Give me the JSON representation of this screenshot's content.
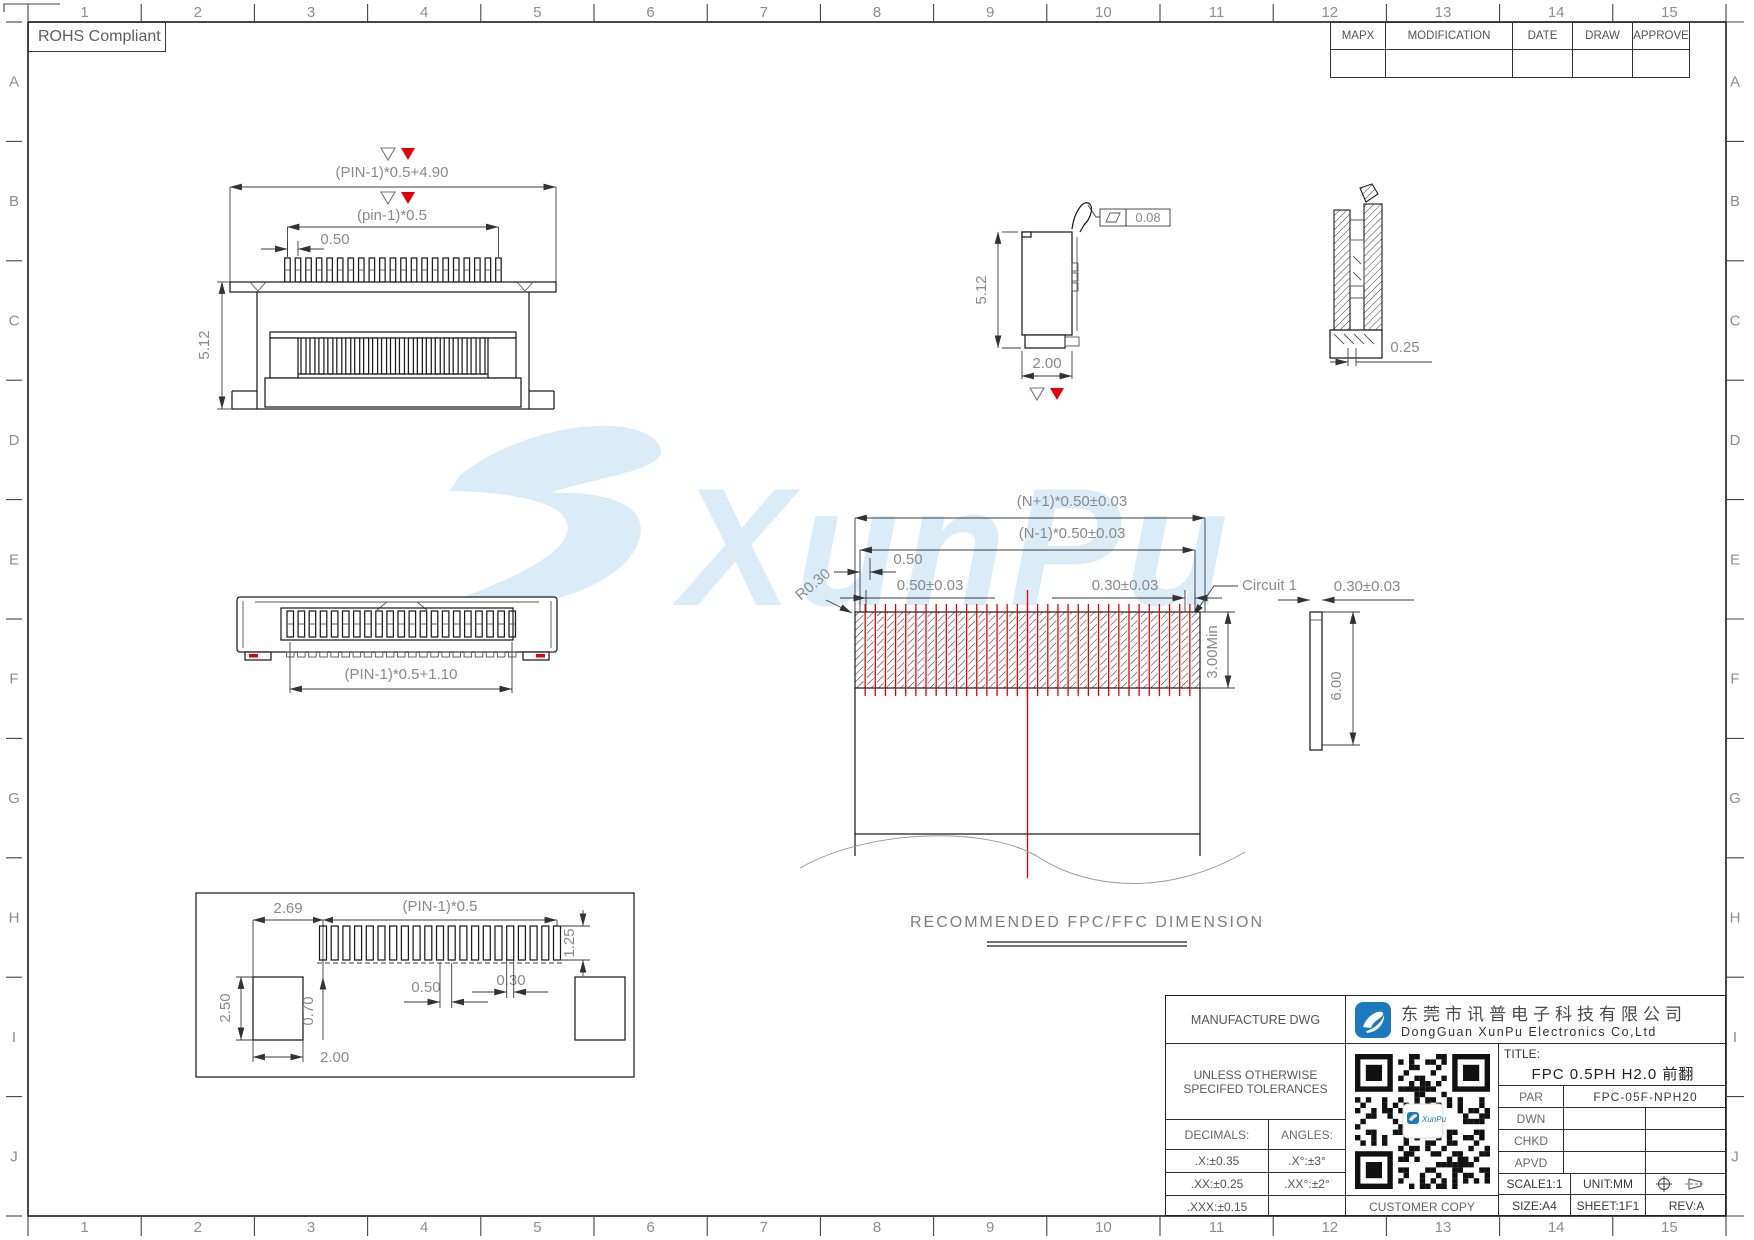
{
  "colors": {
    "line": "#1c1c1c",
    "dim": "#8a8a8a",
    "red": "#e60008",
    "watermark": "#d9ecf8",
    "logo": "#1b79bd"
  },
  "zones": {
    "columns": [
      "1",
      "2",
      "3",
      "4",
      "5",
      "6",
      "7",
      "8",
      "9",
      "10",
      "11",
      "12",
      "13",
      "14",
      "15"
    ],
    "rows": [
      "A",
      "B",
      "C",
      "D",
      "E",
      "F",
      "G",
      "H",
      "I",
      "J"
    ]
  },
  "rohs_label": "ROHS Compliant",
  "revision_table": {
    "headers": [
      "MAPX",
      "MODIFICATION",
      "DATE",
      "DRAW",
      "APPROVE"
    ]
  },
  "watermark_text": "XunPu",
  "drawing_params": {
    "pin_count": 21,
    "fpc_finger_count": 34
  },
  "views": {
    "front": {
      "dim_overall": "(PIN-1)*0.5+4.90",
      "dim_span": "(pin-1)*0.5",
      "dim_pitch": "0.50",
      "dim_height": "5.12"
    },
    "side": {
      "dim_height": "5.12",
      "dim_width": "2.00",
      "flatness": "0.08"
    },
    "section": {
      "dim_offset": "0.25"
    },
    "bottom": {
      "dim_span": "(PIN-1)*0.5+1.10"
    },
    "fpc": {
      "dim_outer": "(N+1)*0.50±0.03",
      "dim_inner": "(N-1)*0.50±0.03",
      "dim_pitch": "0.50",
      "dim_end": "0.50±0.03",
      "dim_finger": "0.30±0.03",
      "circuit_label": "Circuit 1",
      "radius_label": "R0.30",
      "dim_min": "3.00Min",
      "dim_thickness": "0.30±0.03",
      "dim_length": "6.00",
      "caption": "RECOMMENDED FPC/FFC DIMENSION"
    },
    "land": {
      "dim_offset": "2.69",
      "dim_span": "(PIN-1)*0.5",
      "dim_pad_h": "1.25",
      "dim_pitch": "0.50",
      "dim_pad_w": "0.30",
      "dim_anchor_h": "2.50",
      "dim_gap": "0.70",
      "dim_anchor_w": "2.00"
    }
  },
  "title_block": {
    "manufacture": "MANUFACTURE DWG",
    "company_cn": "东莞市讯普电子科技有限公司",
    "company_en": "DongGuan XunPu Electronics Co,Ltd",
    "tolerance_line1": "UNLESS OTHERWISE",
    "tolerance_line2": "SPECIFED TOLERANCES",
    "decimals_header": "DECIMALS:",
    "angles_header": "ANGLES:",
    "tolerance_rows": [
      {
        "decimal": ".X:±0.35",
        "angle": ".X°:±3°"
      },
      {
        "decimal": ".XX:±0.25",
        "angle": ".XX°:±2°"
      },
      {
        "decimal": ".XXX:±0.15",
        "angle": ""
      }
    ],
    "customer_copy": "CUSTOMER COPY",
    "title_label": "TITLE:",
    "title_value": "FPC 0.5PH H2.0 前翻",
    "rows": [
      {
        "label": "PAR",
        "value": "FPC-05F-NPH20"
      },
      {
        "label": "DWN",
        "value": ""
      },
      {
        "label": "CHKD",
        "value": ""
      },
      {
        "label": "APVD",
        "value": ""
      }
    ],
    "scale": "SCALE1:1",
    "unit": "UNIT:MM",
    "size": "SIZE:A4",
    "sheet": "SHEET:1F1",
    "rev": "REV:A",
    "qr_logo_text": "XunPu"
  }
}
